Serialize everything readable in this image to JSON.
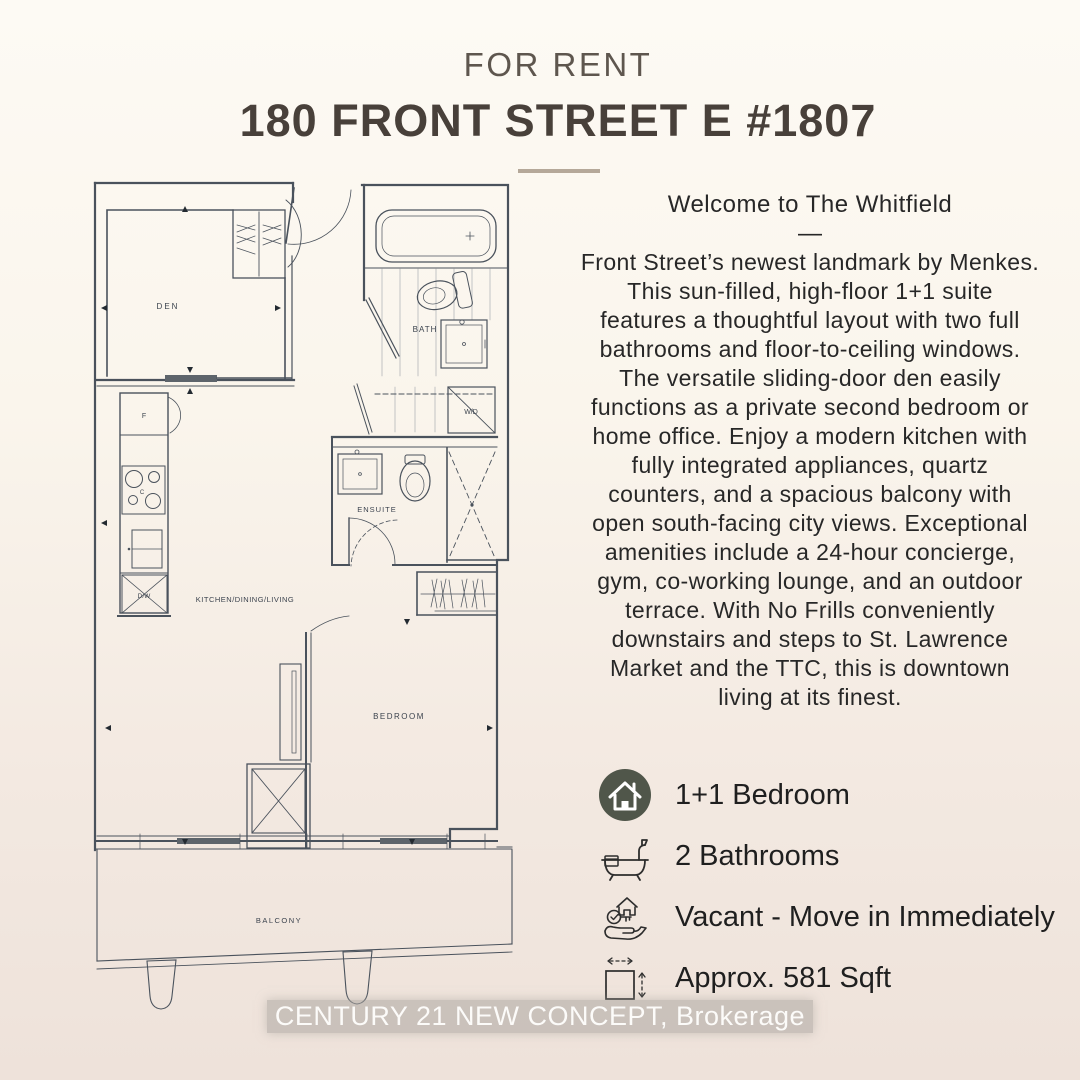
{
  "header": {
    "label": "FOR RENT",
    "title": "180 FRONT STREET E #1807"
  },
  "description": {
    "heading": "Welcome to The Whitfield",
    "dash": "—",
    "lines": [
      "Front Street’s newest landmark by Menkes.",
      "This sun-filled, high-floor 1+1 suite",
      "features a thoughtful layout with two full",
      "bathrooms and floor-to-ceiling windows.",
      "The versatile sliding-door den easily",
      "functions as a private second bedroom or",
      "home office. Enjoy a modern kitchen with",
      "fully integrated appliances, quartz",
      "counters, and a spacious balcony with",
      "open south-facing city views. Exceptional",
      "amenities include a 24-hour concierge,",
      "gym, co-working lounge, and an outdoor",
      "terrace. With No Frills conveniently",
      "downstairs and steps to St. Lawrence",
      "Market and the TTC, this is downtown",
      "living at its finest."
    ]
  },
  "features": [
    {
      "icon": "house-circle-icon",
      "label": "1+1 Bedroom"
    },
    {
      "icon": "bathtub-icon",
      "label": "2 Bathrooms"
    },
    {
      "icon": "key-house-hand-icon",
      "label": "Vacant - Move in Immediately"
    },
    {
      "icon": "floor-area-icon",
      "label": "Approx. 581 Sqft"
    }
  ],
  "floorplan": {
    "labels": {
      "den": "DEN",
      "bath": "BATH",
      "wd": "W/D",
      "ensuite": "ENSUITE",
      "kitchen_living": "KITCHEN/DINING/LIVING",
      "bedroom": "BEDROOM",
      "balcony": "BALCONY",
      "fridge": "F",
      "cooktop": "C",
      "dishwasher": "D/W"
    }
  },
  "footer": {
    "brokerage": "CENTURY 21 NEW CONCEPT, Brokerage"
  },
  "colors": {
    "accent_divider": "#b5a899",
    "house_icon_bg": "#50564a",
    "page_top": "#fdfaf4",
    "page_bottom": "#eee2da",
    "plan_line": "#4a525c",
    "wd_label": "#99997a"
  }
}
